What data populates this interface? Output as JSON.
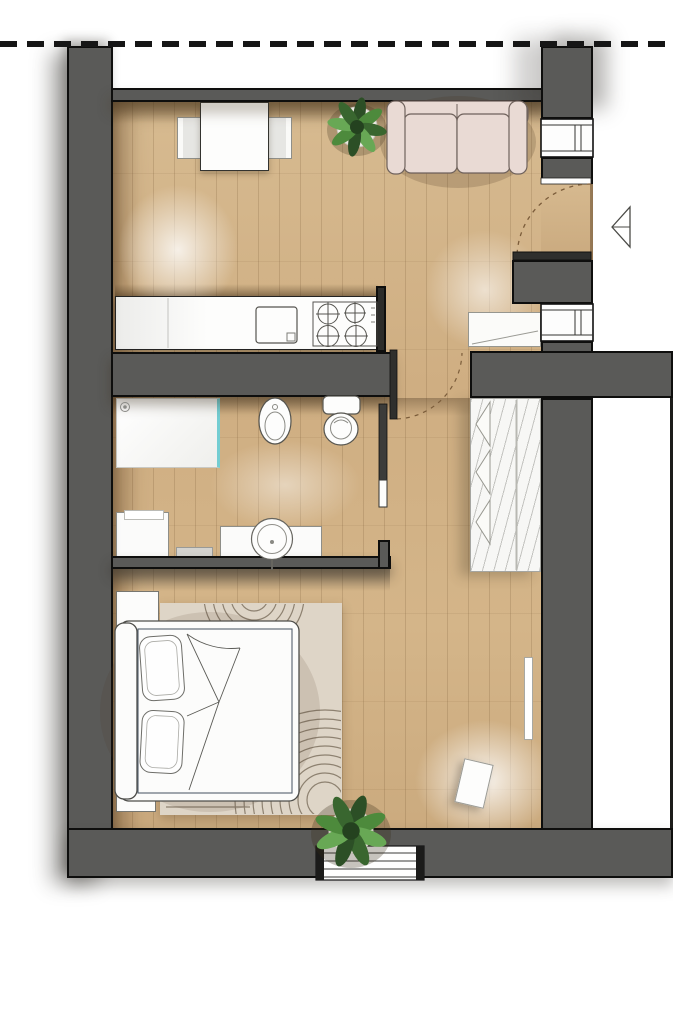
{
  "document": {
    "kind": "apartment-floor-plan-rendering",
    "visible_text": "none"
  },
  "palette": {
    "wall_fill": "#5a5a58",
    "wall_outline": "#0e0e0d",
    "floor_wood": "#cfae82",
    "floor_wood_light": "#d8bd93",
    "rug": "#ded5c7",
    "rug_pattern": "#8d8170",
    "sofa_fabric": "#e9dad4",
    "furniture_outline": "#6f625c",
    "fixture_white": "#fcfcfb",
    "shower_glass_teal": "#74cdd2",
    "plant_dark_green": "#2c4f26",
    "plant_mid_green": "#4d8a3c",
    "plant_light_green": "#68a855",
    "boundary_dash": "#161616",
    "door_leaf": "#2f2f2d",
    "swing_arc": "#7b5c3a"
  },
  "boundary_line": {
    "style": "dashed",
    "position": "top-edge"
  },
  "entry": {
    "arrow_direction": "left",
    "door_swing": "dashed-quarter-arc"
  },
  "rooms": [
    {
      "name": "living-kitchen",
      "items": [
        "dining-table",
        "chair-left",
        "chair-right",
        "sofa",
        "potted-plant",
        "kitchen-counter",
        "kitchen-sink",
        "hob-4-burners"
      ]
    },
    {
      "name": "hallway",
      "items": [
        "entrance-door",
        "hall-cabinet",
        "window-top-right",
        "window-mid-right",
        "entry-arrow"
      ]
    },
    {
      "name": "bathroom",
      "items": [
        "shower",
        "bidet",
        "toilet",
        "washbasin-vanity",
        "washing-machine",
        "bath-mat",
        "bathroom-door"
      ]
    },
    {
      "name": "bedroom",
      "items": [
        "double-bed",
        "pillows",
        "nightstand-top",
        "nightstand-bottom",
        "rug",
        "wardrobe",
        "radiator",
        "leaning-panel",
        "potted-plant",
        "window-bottom"
      ]
    }
  ]
}
